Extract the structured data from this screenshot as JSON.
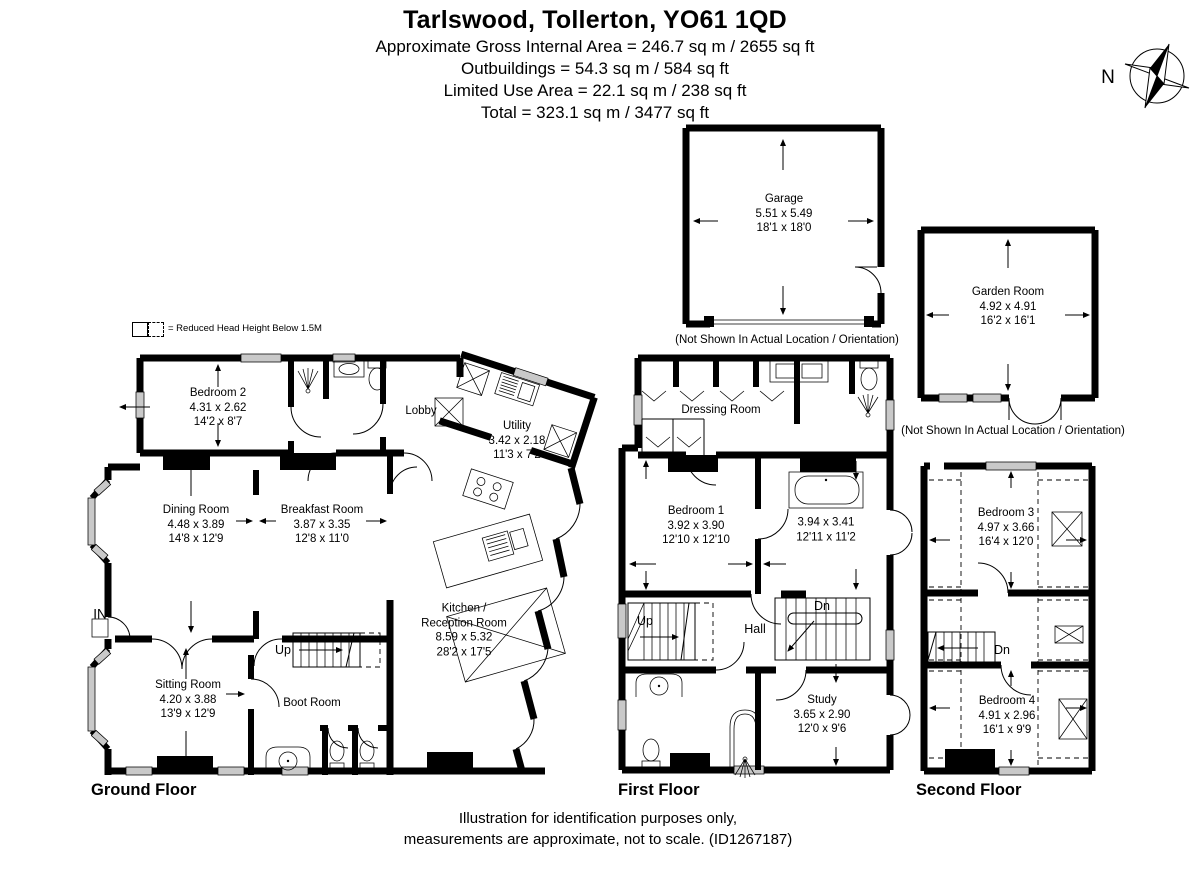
{
  "header": {
    "title": "Tarlswood, Tollerton, YO61 1QD",
    "line1": "Approximate Gross Internal Area = 246.7 sq m / 2655 sq ft",
    "line2": "Outbuildings = 54.3 sq m / 584 sq ft",
    "line3": "Limited Use Area = 22.1 sq m / 238 sq ft",
    "line4": "Total = 323.1 sq m / 3477 sq ft"
  },
  "compass": {
    "north": "N"
  },
  "legend": {
    "text": "= Reduced Head Height Below 1.5M"
  },
  "outbuildings": {
    "garage": {
      "name": "Garage",
      "metric": "5.51 x 5.49",
      "imperial": "18'1 x 18'0",
      "caption": "(Not Shown In Actual Location / Orientation)"
    },
    "garden_room": {
      "name": "Garden Room",
      "metric": "4.92 x 4.91",
      "imperial": "16'2 x 16'1",
      "caption": "(Not Shown In Actual Location / Orientation)"
    }
  },
  "ground_floor": {
    "label": "Ground Floor",
    "rooms": {
      "bedroom2": {
        "name": "Bedroom 2",
        "metric": "4.31 x 2.62",
        "imperial": "14'2 x 8'7"
      },
      "lobby": {
        "name": "Lobby"
      },
      "utility": {
        "name": "Utility",
        "metric": "3.42 x 2.18",
        "imperial": "11'3 x 7'2"
      },
      "dining": {
        "name": "Dining Room",
        "metric": "4.48 x 3.89",
        "imperial": "14'8 x 12'9"
      },
      "breakfast": {
        "name": "Breakfast Room",
        "metric": "3.87 x 3.35",
        "imperial": "12'8 x 11'0"
      },
      "kitchen": {
        "name1": "Kitchen /",
        "name2": "Reception Room",
        "metric": "8.59 x 5.32",
        "imperial": "28'2 x 17'5"
      },
      "sitting": {
        "name": "Sitting Room",
        "metric": "4.20 x 3.88",
        "imperial": "13'9 x 12'9"
      },
      "boot": {
        "name": "Boot Room"
      }
    },
    "annotations": {
      "up": "Up",
      "entrance": "IN"
    }
  },
  "first_floor": {
    "label": "First Floor",
    "rooms": {
      "dressing": {
        "name": "Dressing Room"
      },
      "bedroom1": {
        "name": "Bedroom 1",
        "metric": "3.92 x 3.90",
        "imperial": "12'10 x 12'10"
      },
      "bathroom": {
        "metric": "3.94 x 3.41",
        "imperial": "12'11 x 11'2"
      },
      "hall": {
        "name": "Hall"
      },
      "study": {
        "name": "Study",
        "metric": "3.65 x 2.90",
        "imperial": "12'0 x 9'6"
      }
    },
    "annotations": {
      "up": "Up",
      "dn": "Dn"
    }
  },
  "second_floor": {
    "label": "Second Floor",
    "rooms": {
      "bedroom3": {
        "name": "Bedroom 3",
        "metric": "4.97 x 3.66",
        "imperial": "16'4 x 12'0"
      },
      "bedroom4": {
        "name": "Bedroom 4",
        "metric": "4.91 x 2.96",
        "imperial": "16'1 x 9'9"
      }
    },
    "annotations": {
      "dn": "Dn"
    }
  },
  "footer": {
    "line1": "Illustration for identification purposes only,",
    "line2": "measurements are approximate, not to scale. (ID1267187)"
  }
}
